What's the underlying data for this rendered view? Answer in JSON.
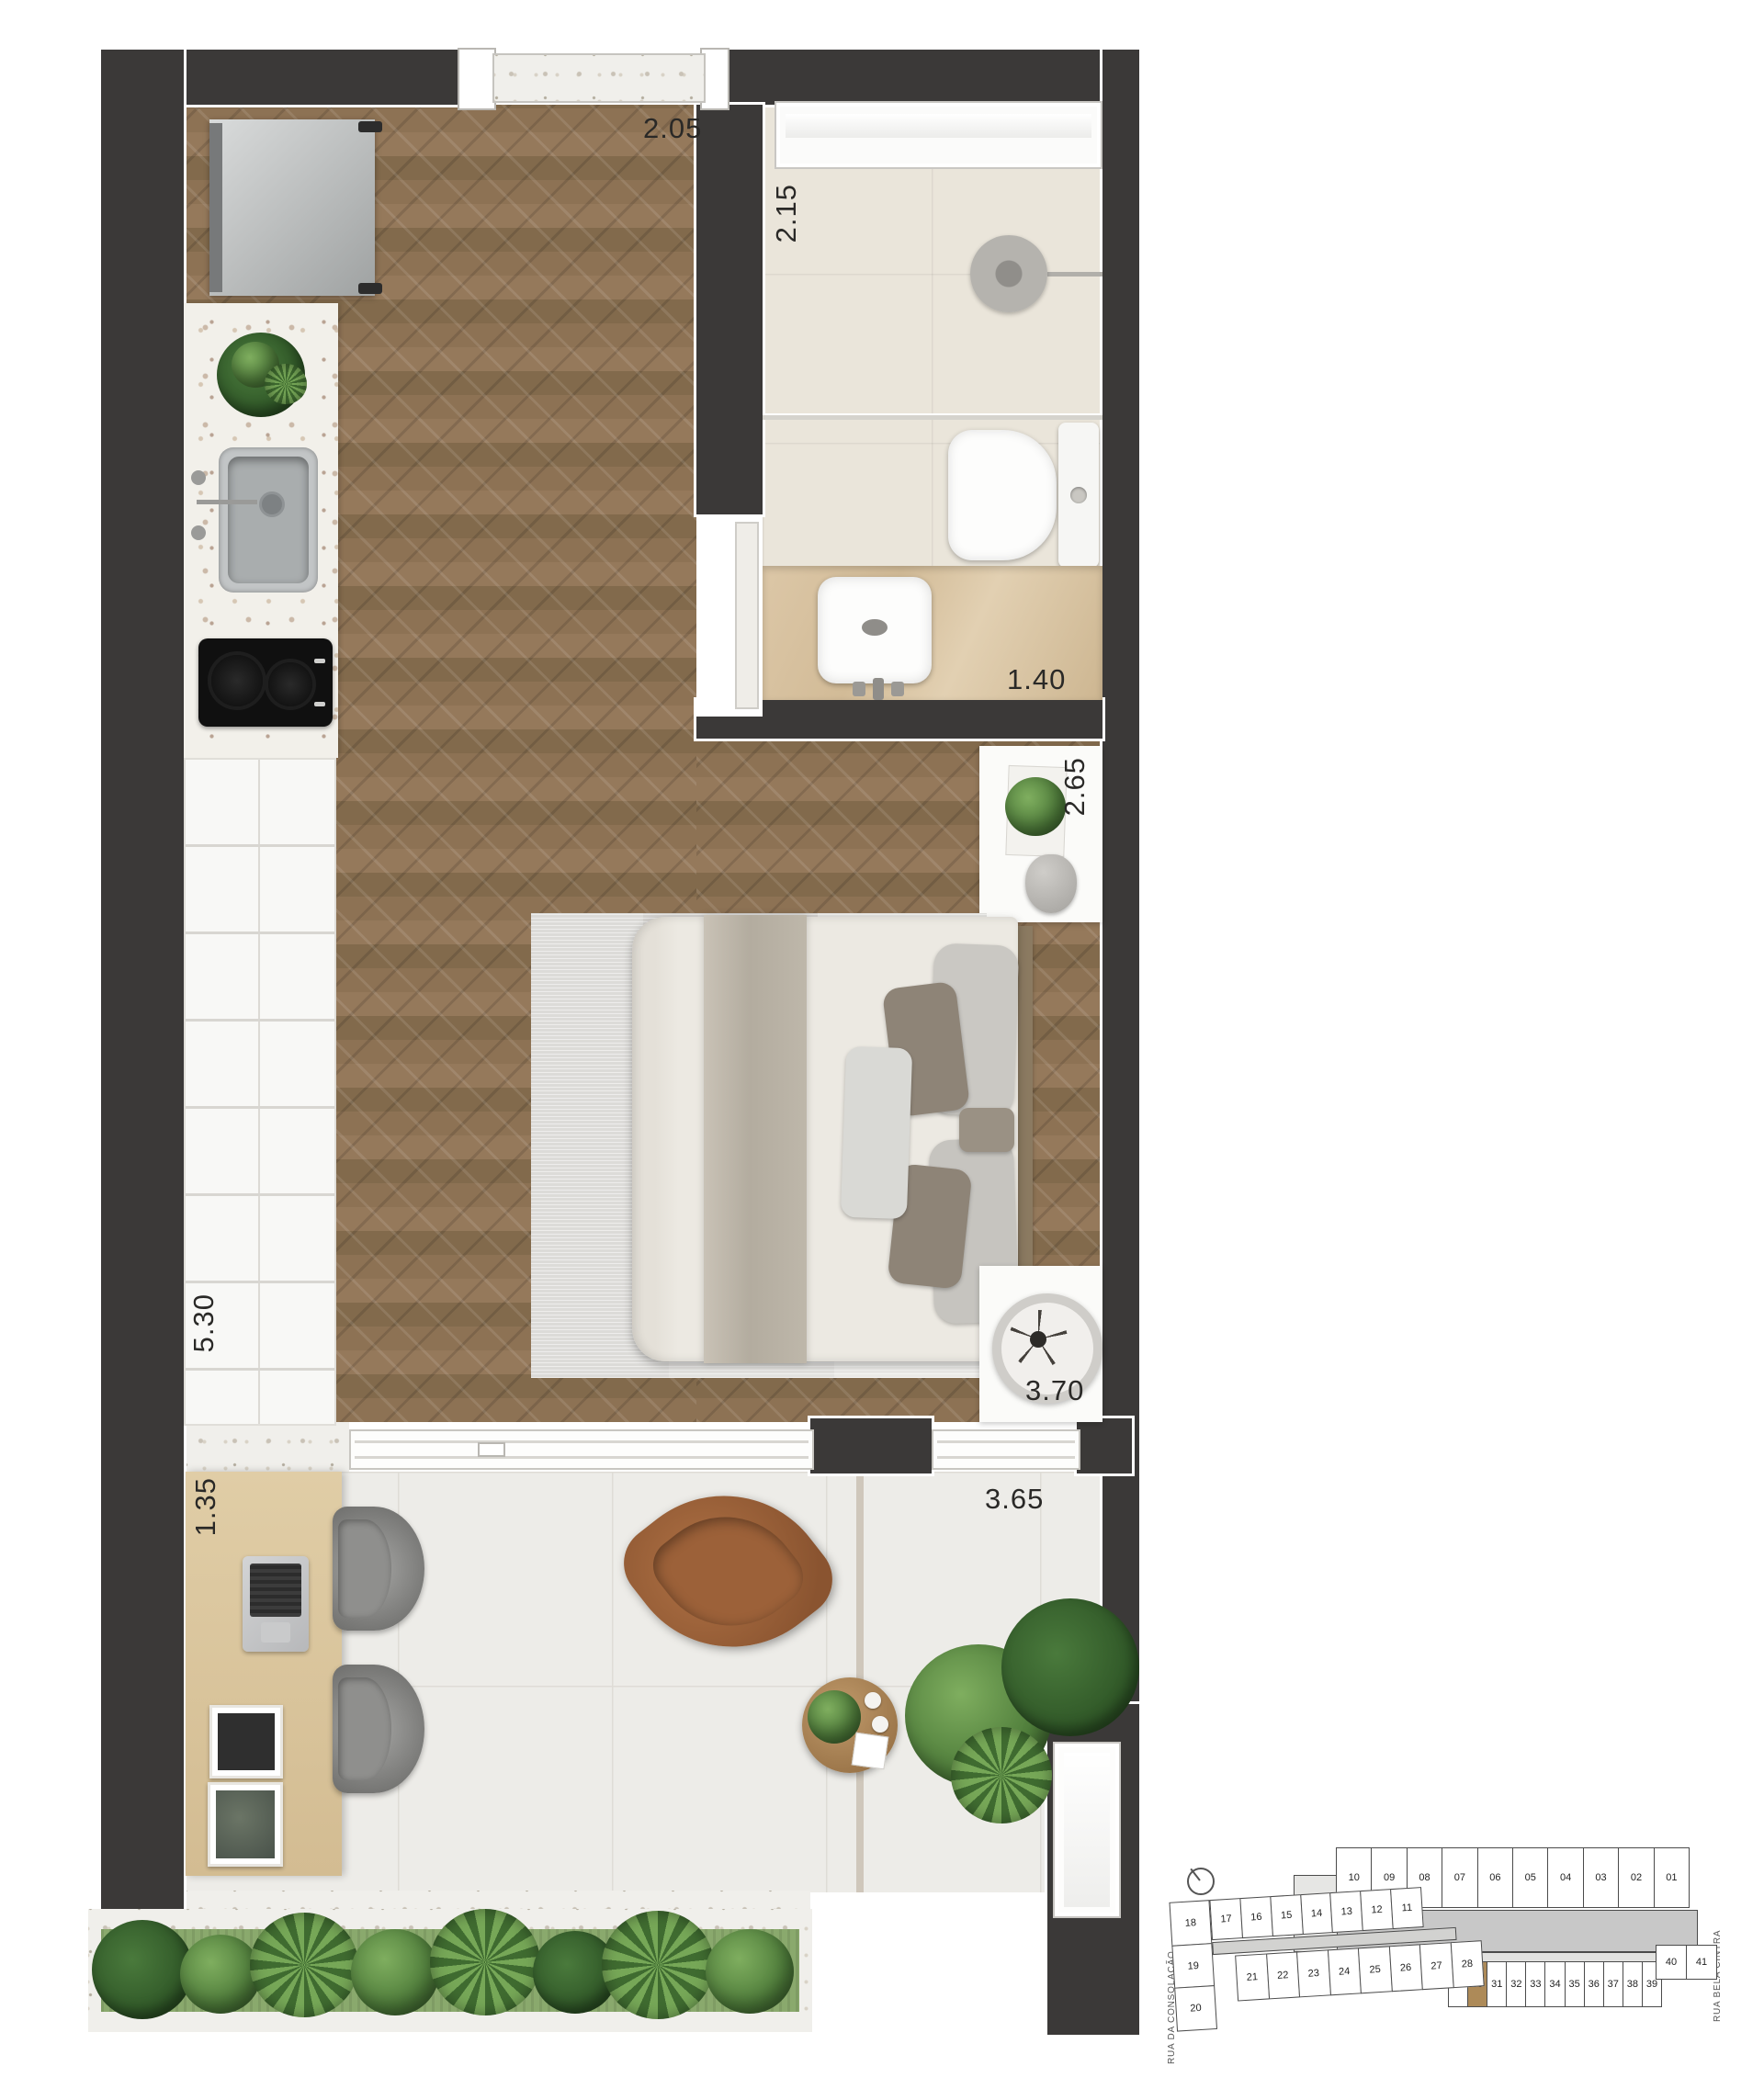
{
  "floorplan": {
    "colors": {
      "wall": "#3b3938",
      "wood_floor": "#8a6e51",
      "unit_highlight": "#ad8a58",
      "plant_green": "#4e7c3a"
    },
    "dimensions": {
      "entry_width": "2.05",
      "bathroom_width": "2.15",
      "vanity_width": "1.40",
      "bedroom_width": "2.65",
      "closet_run": "5.30",
      "bedroom_length": "3.70",
      "desk_width": "1.35",
      "terrace_width": "3.65"
    }
  },
  "keyplan": {
    "streets": {
      "left": "RUA DA CONSOLAÇÃO",
      "right": "RUA BELA CINTRA"
    },
    "highlighted_unit": "30",
    "rows": {
      "top": [
        "10",
        "09",
        "08",
        "07",
        "06",
        "05",
        "04",
        "03",
        "02",
        "01"
      ],
      "middle": [
        "17",
        "16",
        "15",
        "14",
        "13",
        "12",
        "11"
      ],
      "left_column": [
        "18",
        "19",
        "20"
      ],
      "lower_left": [
        "21",
        "22",
        "23",
        "24",
        "25",
        "26",
        "27",
        "28"
      ],
      "bottom": [
        "29",
        "30",
        "31",
        "32",
        "33",
        "34",
        "35",
        "36",
        "37",
        "38",
        "39"
      ],
      "right": [
        "40",
        "41"
      ]
    }
  }
}
